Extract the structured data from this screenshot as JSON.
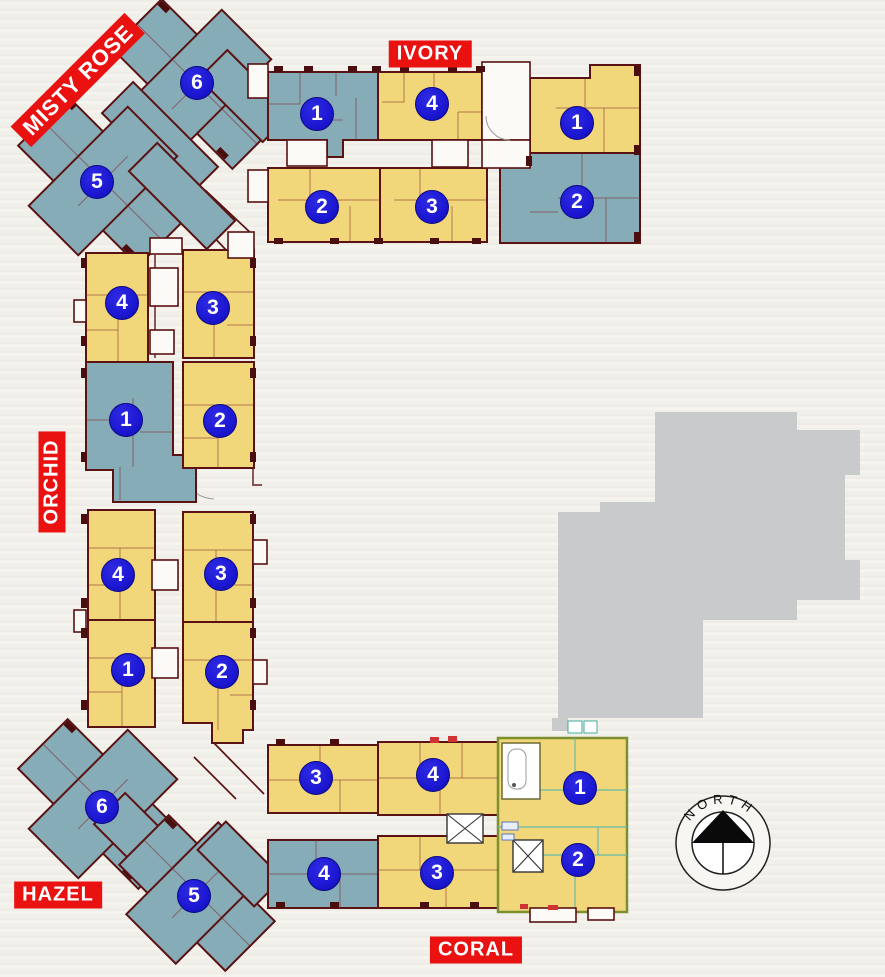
{
  "plan": {
    "wings": [
      {
        "id": "misty-rose",
        "label": "MISTY ROSE"
      },
      {
        "id": "ivory",
        "label": "IVORY"
      },
      {
        "id": "orchid",
        "label": "ORCHID"
      },
      {
        "id": "hazel",
        "label": "HAZEL"
      },
      {
        "id": "coral",
        "label": "CORAL"
      }
    ],
    "units": [
      {
        "wing": "misty-rose",
        "number": "6"
      },
      {
        "wing": "misty-rose",
        "number": "5"
      },
      {
        "wing": "ivory",
        "number": "1"
      },
      {
        "wing": "ivory",
        "number": "4"
      },
      {
        "wing": "ivory",
        "number": "1"
      },
      {
        "wing": "ivory",
        "number": "2"
      },
      {
        "wing": "ivory",
        "number": "3"
      },
      {
        "wing": "ivory",
        "number": "2"
      },
      {
        "wing": "orchid",
        "number": "4"
      },
      {
        "wing": "orchid",
        "number": "3"
      },
      {
        "wing": "orchid",
        "number": "1"
      },
      {
        "wing": "orchid",
        "number": "2"
      },
      {
        "wing": "orchid",
        "number": "4"
      },
      {
        "wing": "orchid",
        "number": "3"
      },
      {
        "wing": "orchid",
        "number": "1"
      },
      {
        "wing": "orchid",
        "number": "2"
      },
      {
        "wing": "hazel",
        "number": "6"
      },
      {
        "wing": "hazel",
        "number": "5"
      },
      {
        "wing": "coral",
        "number": "3"
      },
      {
        "wing": "coral",
        "number": "4"
      },
      {
        "wing": "coral",
        "number": "1"
      },
      {
        "wing": "coral",
        "number": "4"
      },
      {
        "wing": "coral",
        "number": "3"
      },
      {
        "wing": "coral",
        "number": "2"
      }
    ],
    "compass": {
      "label": "NORTH"
    },
    "colors": {
      "unit_yellow": "#f2d67a",
      "unit_blue": "#86acb8",
      "wall_maroon": "#5a1212",
      "label_red": "#ea1111",
      "badge_blue": "#1c17d2",
      "silhouette_gray": "#c9cacc",
      "coral_outline_olive": "#7d9030",
      "coral_interior_teal": "#57b8ae"
    }
  }
}
